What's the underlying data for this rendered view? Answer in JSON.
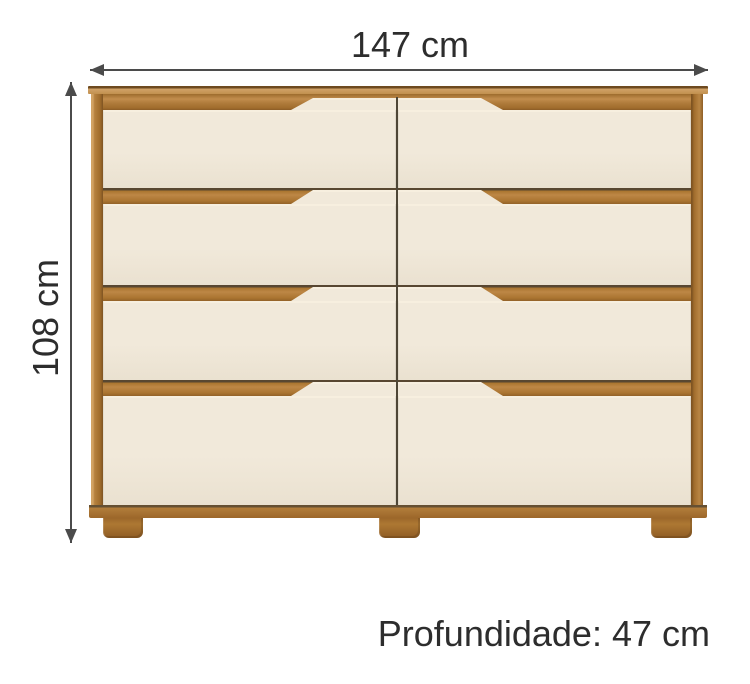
{
  "labels": {
    "width": "147 cm",
    "height": "108 cm",
    "depth": "Profundidade: 47 cm"
  },
  "furniture": {
    "drawer_rows": 4,
    "drawer_columns": 2,
    "feet_count": 3
  },
  "colors": {
    "wood": "#b07c3c",
    "wood_light": "#cfa064",
    "wood_dark": "#8a5c26",
    "drawer_front": "#f1e9da",
    "dimension_line": "#4b4b4b",
    "text": "#2d2d2d",
    "divider": "#4e4636",
    "background": "#ffffff"
  }
}
